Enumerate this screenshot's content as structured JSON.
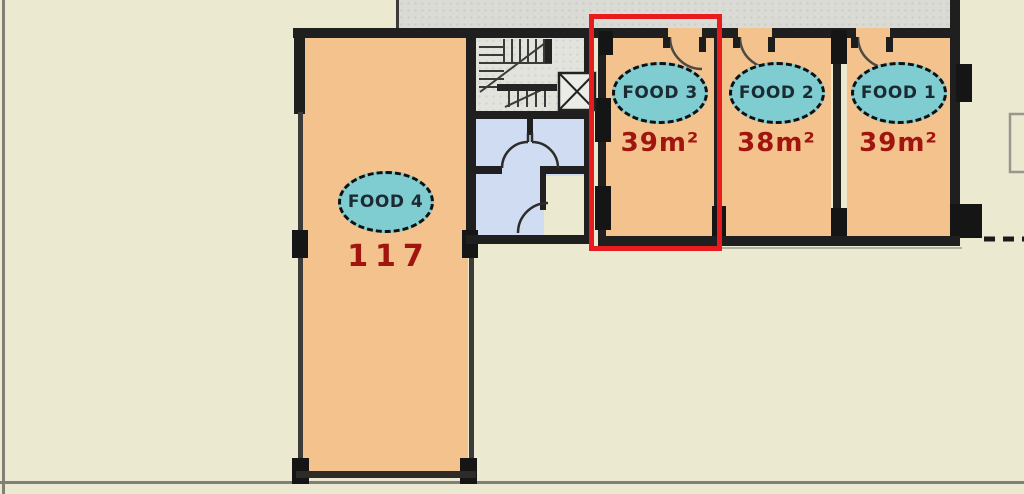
{
  "units": {
    "food4": {
      "label": "FOOD 4",
      "area": "117"
    },
    "food3": {
      "label": "FOOD 3",
      "area": "39m²"
    },
    "food2": {
      "label": "FOOD 2",
      "area": "38m²"
    },
    "food1": {
      "label": "FOOD 1",
      "area": "39m²"
    }
  },
  "highlight": {
    "selected_unit": "FOOD 3",
    "color": "#e81b1e"
  },
  "colors": {
    "background": "#ece9d1",
    "room_fill": "#f4c28d",
    "label_ellipse_fill": "#7fcdd0",
    "label_text": "#1c2a33",
    "area_text": "#a0150e",
    "wall": "#1f1f1f",
    "bathroom_floor": "#cfdcf2",
    "terrace": "#dbdbd6",
    "highlight_red": "#e81b1e"
  }
}
